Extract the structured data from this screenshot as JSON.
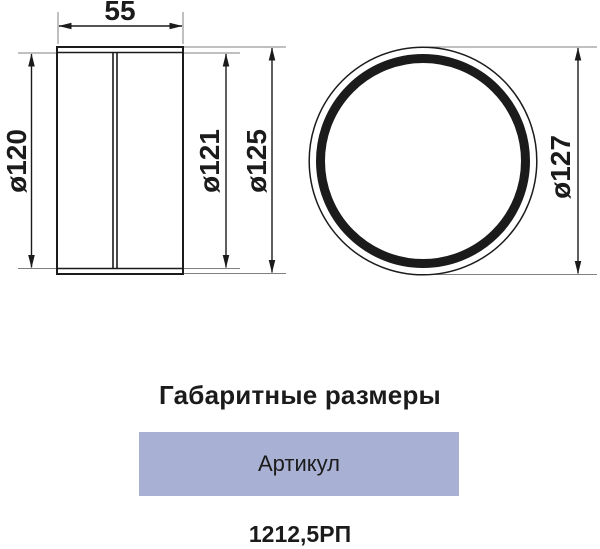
{
  "colors": {
    "line": "#1b1b1b",
    "extension_line": "#808080",
    "article_box_bg": "#a8b1d3",
    "text": "#1b1b1b"
  },
  "drawing": {
    "side_view": {
      "length_label": "55",
      "inner_diameter_label": "ø120",
      "middle_diameter_label": "ø121",
      "outer_diameter_label": "ø125"
    },
    "front_view": {
      "outer_diameter_label": "ø127"
    }
  },
  "section_title": "Габаритные размеры",
  "article_table": {
    "header": "Артикул",
    "value": "1212,5РП"
  }
}
